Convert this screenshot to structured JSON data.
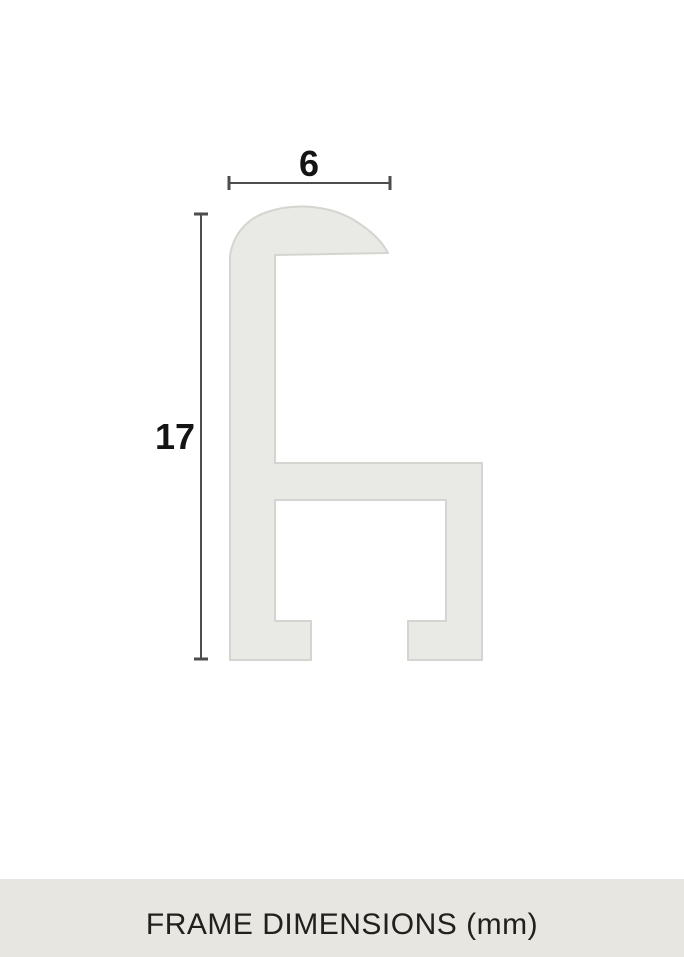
{
  "drawing": {
    "type": "frame-profile-cross-section",
    "width_dimension": {
      "label": "6",
      "value": 6,
      "unit": "mm"
    },
    "height_dimension": {
      "label": "17",
      "value": 17,
      "unit": "mm"
    }
  },
  "footer": {
    "caption": "FRAME DIMENSIONS (mm)"
  },
  "colors": {
    "canvas_background": "#ffffff",
    "profile_fill": "#e9e9e6",
    "profile_stroke": "#d4d4d1",
    "dimension_line": "#4d4d4d",
    "dimension_text": "#141414",
    "footer_background": "#e8e6e1",
    "footer_text": "#21201e"
  }
}
